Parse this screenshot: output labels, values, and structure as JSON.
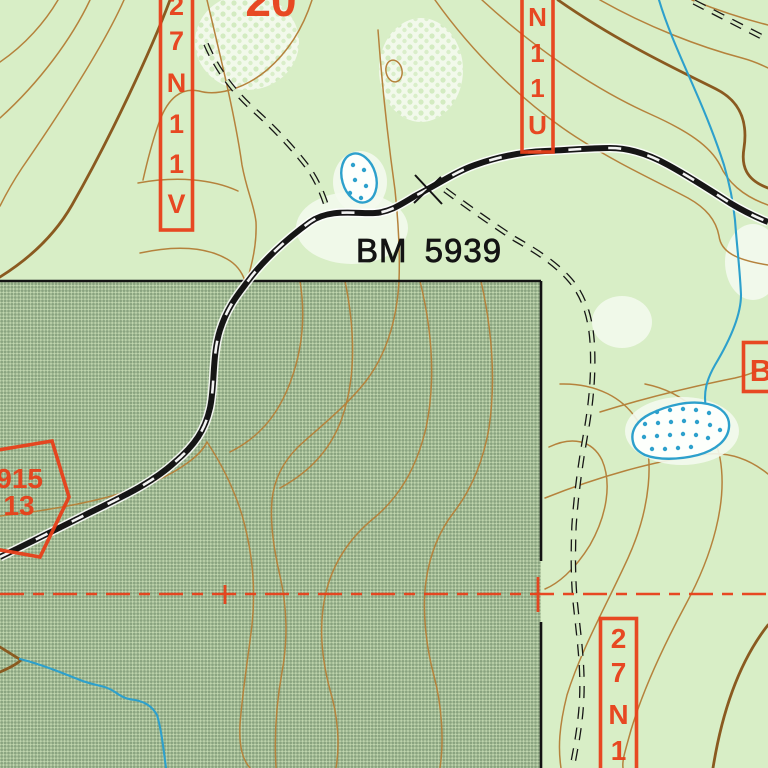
{
  "map": {
    "kind": "usgs-topographic-map-detail",
    "section_label": "20",
    "benchmark": {
      "label": "BM 5939"
    },
    "road_labels": {
      "west": {
        "id": "27N11V",
        "chars": [
          "2",
          "7",
          "N",
          "1",
          "1",
          "V"
        ]
      },
      "north": {
        "id": "N11U",
        "chars": [
          "N",
          "1",
          "1",
          "U"
        ]
      },
      "southeast": {
        "id": "27N1",
        "chars": [
          "2",
          "7",
          "N",
          "1"
        ]
      },
      "east": {
        "id": "B",
        "chars": [
          "B"
        ]
      }
    },
    "route_shield": {
      "line1": "915",
      "line2": "13"
    },
    "legend": {
      "shaded_overlay": "land-status-halftone-overlay",
      "ponds": "intermittent-pond-dotted",
      "road": "unimproved-dirt-road",
      "trails": "four-wheel-drive-trail-double-dash",
      "section_line": "red-dashed-section-line",
      "benchmark_mark": "x-station-mark"
    },
    "colors": {
      "background": "#d8eec6",
      "shaded_overlay_net": "#a2ba94",
      "contour": "#b5823c",
      "index_contour": "#8a5a20",
      "water": "#2da0cc",
      "overprint_red": "#e8401a",
      "linework_black": "#161616",
      "clearing_white": "#f4faee"
    }
  }
}
